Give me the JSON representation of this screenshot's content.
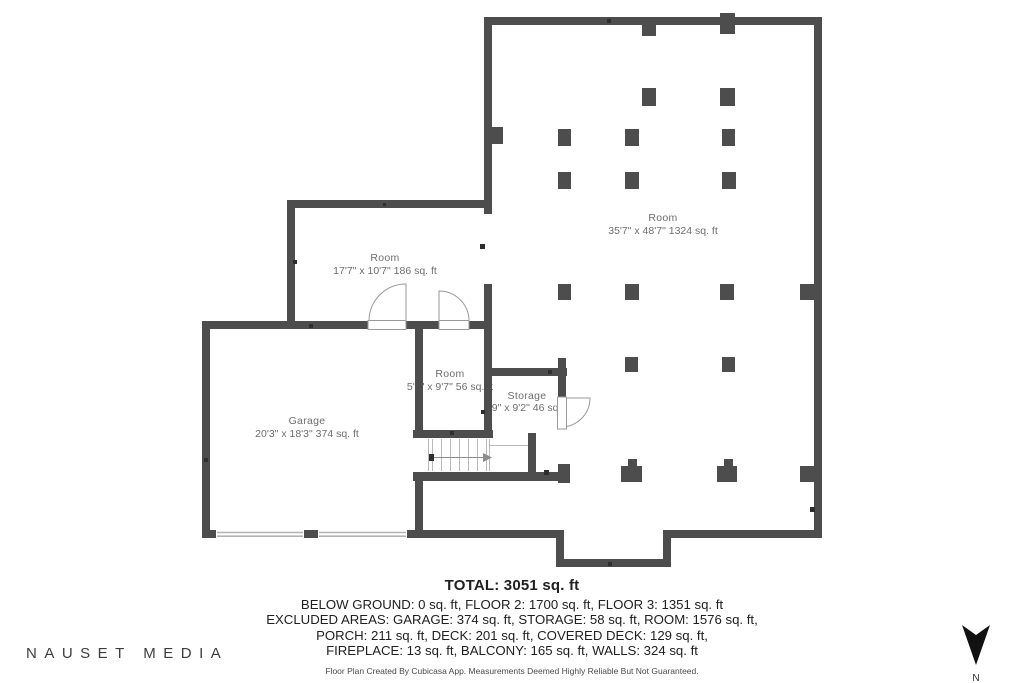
{
  "rooms": [
    {
      "name": "Room",
      "dims": "35'7\" x 48'7\" 1324 sq. ft"
    },
    {
      "name": "Room",
      "dims": "17'7\" x 10'7\" 186 sq. ft"
    },
    {
      "name": "Garage",
      "dims": "20'3\" x 18'3\" 374 sq. ft"
    },
    {
      "name": "Room",
      "dims": "5'9\" x 9'7\" 56 sq. ft"
    },
    {
      "name": "Storage",
      "dims": "6'9\" x 9'2\" 46 sq. ft"
    }
  ],
  "summary": {
    "total": "TOTAL: 3051 sq. ft",
    "line1": "BELOW GROUND: 0 sq. ft, FLOOR 2: 1700 sq. ft, FLOOR 3: 1351 sq. ft",
    "line2": "EXCLUDED AREAS: GARAGE: 374 sq. ft, STORAGE: 58 sq. ft, ROOM: 1576 sq. ft,",
    "line3": "PORCH: 211 sq. ft, DECK: 201 sq. ft, COVERED DECK: 129 sq. ft,",
    "line4": "FIREPLACE: 13 sq. ft, BALCONY: 165 sq. ft, WALLS: 324 sq. ft",
    "disclaimer": "Floor Plan Created By Cubicasa App. Measurements Deemed Highly Reliable But Not Guaranteed."
  },
  "branding": {
    "logo": "NAUSET MEDIA"
  },
  "compass": {
    "label": "N"
  },
  "colors": {
    "wall": "#4d4d4d",
    "tick": "#2e2e2e",
    "doorline": "#9a9a9a",
    "stairline": "#b9b9b9",
    "garagedoor": "#b3b3b3",
    "label": "#6e6e6e",
    "text": "#202020",
    "brand": "#3d3d3d",
    "compass": "#111111"
  }
}
